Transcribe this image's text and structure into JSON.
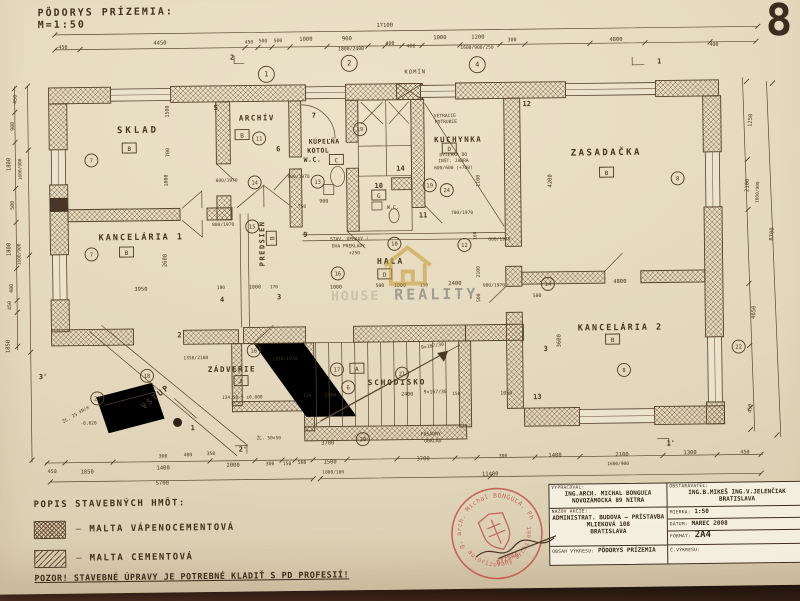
{
  "header": {
    "title": "PÔDORYS PRÍZEMIA:",
    "scale": "M=1:50",
    "sheet_number": "8"
  },
  "watermark": {
    "text_left": "HOUSE",
    "text_right": "REALITY",
    "house_color": "#c79a2e"
  },
  "legend": {
    "title": "POPIS STAVEBNÝCH HMÔT:",
    "items": [
      "MALTA VÁPENOCEMENTOVÁ",
      "MALTA CEMENTOVÁ"
    ],
    "dash": "—",
    "warning": "POZOR! STAVEBNÉ ÚPRAVY JE POTREBNÉ KLADIŤ S PD PROFESIÍ!"
  },
  "titleblock": {
    "vypracoval_label": "VYPRACOVAL:",
    "vypracoval1": "ING.ARCH. MICHAL BONGUĽA",
    "vypracoval2": "NOVOZÁMOCKÁ 89 NITRA",
    "obstaravatel_label": "OBSTARÁVATEĽ:",
    "obstaravatel1": "ING.B.MIKEŠ  ING.V.JELENČIAK",
    "obstaravatel2": "BRATISLAVA",
    "nazov_label": "NÁZOV AKCIE:",
    "nazov1": "ADMINISTRAT. BUDOVA – PRÍSTAVBA",
    "nazov2": "MLIEKOVÁ 108",
    "nazov3": "BRATISLAVA",
    "mierka_label": "MIERKA:",
    "mierka": "1:50",
    "datum_label": "DÁTUM:",
    "datum": "MAREC 2008",
    "format_label": "FORMÁT:",
    "format": "2A4",
    "cislo_label": "Č.VÝKRESU:",
    "cislo": "",
    "obsah_label": "OBSAH VÝKRESU:",
    "obsah": "PÔDORYS PRÍZEMIA"
  },
  "stamp": {
    "arc_top": "Ing. arch. Michal BONGUĽA, PhD.",
    "arc_bottom": "autorizovaný architekt",
    "code": "0725AA",
    "color": "#bf4f49"
  },
  "plan": {
    "rooms": [
      {
        "name": "SKLAD",
        "x": 137,
        "y": 134,
        "s": 9,
        "ls": 3
      },
      {
        "name": "KANCELÁRIA 1",
        "x": 139,
        "y": 241,
        "s": 8.5,
        "ls": 2
      },
      {
        "name": "ARCHÍV",
        "x": 256,
        "y": 123,
        "s": 7.5,
        "ls": 1.5
      },
      {
        "name": "PREDSIEŇ",
        "x": 262,
        "y": 246,
        "s": 7,
        "ls": 1.5,
        "r": -90
      },
      {
        "name": "KÚPEĽŇA",
        "x": 323,
        "y": 147,
        "s": 6.5,
        "ls": 0.5
      },
      {
        "name": "KOTOL",
        "x": 317,
        "y": 156,
        "s": 6.5,
        "ls": 0.5
      },
      {
        "name": "W.C.",
        "x": 311,
        "y": 165,
        "s": 6.5,
        "ls": 0.5
      },
      {
        "name": "KUCHYNKA",
        "x": 457,
        "y": 147,
        "s": 7.5,
        "ls": 1.5
      },
      {
        "name": "ZASADAČKA",
        "x": 605,
        "y": 162,
        "s": 9,
        "ls": 2.5
      },
      {
        "name": "HALA",
        "x": 388,
        "y": 268,
        "s": 8,
        "ls": 2
      },
      {
        "name": "KANCELÁRIA 2",
        "x": 617,
        "y": 337,
        "s": 8.5,
        "ls": 2
      },
      {
        "name": "ZÁDVERIE",
        "x": 228,
        "y": 374,
        "s": 7.5,
        "ls": 1.5
      },
      {
        "name": "VSTUP",
        "x": 153,
        "y": 400,
        "s": 8,
        "ls": 2,
        "r": -38
      },
      {
        "name": "SCHODISKO",
        "x": 393,
        "y": 389,
        "s": 7.5,
        "ls": 2
      }
    ],
    "letter_boxes": [
      {
        "t": "B",
        "x": 128,
        "y": 150
      },
      {
        "t": "B",
        "x": 124,
        "y": 254
      },
      {
        "t": "B",
        "x": 241,
        "y": 138
      },
      {
        "t": "C",
        "x": 335,
        "y": 164
      },
      {
        "t": "D",
        "x": 448,
        "y": 154
      },
      {
        "t": "B",
        "x": 605,
        "y": 180
      },
      {
        "t": "D",
        "x": 382,
        "y": 279
      },
      {
        "t": "B",
        "x": 609,
        "y": 347
      },
      {
        "t": "A",
        "x": 237,
        "y": 384
      },
      {
        "t": "A",
        "x": 353,
        "y": 373
      },
      {
        "t": "G",
        "x": 377,
        "y": 200
      },
      {
        "t": "B",
        "x": 270,
        "y": 241,
        "r": -90
      }
    ],
    "circle_marks": [
      {
        "n": "7",
        "x": 90,
        "y": 161
      },
      {
        "n": "7",
        "x": 89,
        "y": 255
      },
      {
        "n": "11",
        "x": 258,
        "y": 141
      },
      {
        "n": "14",
        "x": 253,
        "y": 185
      },
      {
        "n": "15",
        "x": 250,
        "y": 229
      },
      {
        "n": "13",
        "x": 316,
        "y": 185
      },
      {
        "n": "19",
        "x": 359,
        "y": 133
      },
      {
        "n": "19",
        "x": 428,
        "y": 190
      },
      {
        "n": "24",
        "x": 445,
        "y": 195
      },
      {
        "n": "12",
        "x": 462,
        "y": 250
      },
      {
        "n": "10",
        "x": 392,
        "y": 248
      },
      {
        "n": "16",
        "x": 335,
        "y": 277
      },
      {
        "n": "8",
        "x": 676,
        "y": 186
      },
      {
        "n": "8",
        "x": 620,
        "y": 377
      },
      {
        "n": "14",
        "x": 545,
        "y": 290
      },
      {
        "n": "16",
        "x": 250,
        "y": 353
      },
      {
        "n": "18",
        "x": 143,
        "y": 377
      },
      {
        "n": "23",
        "x": 93,
        "y": 399
      },
      {
        "n": "17",
        "x": 333,
        "y": 373
      },
      {
        "n": "21",
        "x": 398,
        "y": 378
      },
      {
        "n": "6",
        "x": 344,
        "y": 391
      },
      {
        "n": "20",
        "x": 358,
        "y": 443
      },
      {
        "n": "22",
        "x": 735,
        "y": 355
      }
    ],
    "grid_marks": [
      {
        "n": "1",
        "x": 266,
        "y": 77
      },
      {
        "n": "2",
        "x": 349,
        "y": 67
      },
      {
        "n": "4",
        "x": 477,
        "y": 70
      }
    ],
    "wall_marks": [
      {
        "t": "5",
        "x": 215,
        "y": 112
      },
      {
        "t": "6",
        "x": 277,
        "y": 154
      },
      {
        "t": "12",
        "x": 526,
        "y": 112
      },
      {
        "t": "11",
        "x": 421,
        "y": 222
      },
      {
        "t": "13",
        "x": 533,
        "y": 405
      },
      {
        "t": "4",
        "x": 219,
        "y": 304
      },
      {
        "t": "3",
        "x": 276,
        "y": 302
      },
      {
        "t": "9",
        "x": 303,
        "y": 240
      },
      {
        "t": "10",
        "x": 377,
        "y": 192
      },
      {
        "t": "14",
        "x": 399,
        "y": 175
      },
      {
        "t": "2",
        "x": 176,
        "y": 339
      },
      {
        "t": "1",
        "x": 188,
        "y": 432
      },
      {
        "t": "7",
        "x": 313,
        "y": 121
      },
      {
        "t": "2",
        "x": 232,
        "y": 62
      },
      {
        "t": "1",
        "x": 659,
        "y": 71
      },
      {
        "t": "1'",
        "x": 666,
        "y": 453
      },
      {
        "t": "2'",
        "x": 238,
        "y": 454
      },
      {
        "t": "3'",
        "x": 39,
        "y": 379
      },
      {
        "t": "3",
        "x": 542,
        "y": 357
      }
    ],
    "dim_texts": [
      {
        "t": "17100",
        "x": 385,
        "y": 31
      },
      {
        "t": "450",
        "x": 63,
        "y": 49,
        "s": 5
      },
      {
        "t": "4450",
        "x": 160,
        "y": 46
      },
      {
        "t": "450",
        "x": 249,
        "y": 46,
        "s": 4.8
      },
      {
        "t": "500",
        "x": 263,
        "y": 45,
        "s": 4.8
      },
      {
        "t": "500",
        "x": 278,
        "y": 45,
        "s": 4.8
      },
      {
        "t": "1000",
        "x": 306,
        "y": 44
      },
      {
        "t": "900",
        "x": 347,
        "y": 44
      },
      {
        "t": "1800/2400",
        "x": 351,
        "y": 54,
        "s": 4.8
      },
      {
        "t": "400",
        "x": 390,
        "y": 49,
        "s": 5
      },
      {
        "t": "400",
        "x": 411,
        "y": 52,
        "s": 5
      },
      {
        "t": "1000",
        "x": 440,
        "y": 44
      },
      {
        "t": "1200",
        "x": 478,
        "y": 44
      },
      {
        "t": "1600/900/250",
        "x": 477,
        "y": 54,
        "s": 4.6
      },
      {
        "t": "300",
        "x": 512,
        "y": 47,
        "s": 5
      },
      {
        "t": "4800",
        "x": 616,
        "y": 48
      },
      {
        "t": "400",
        "x": 714,
        "y": 54,
        "s": 5
      },
      {
        "t": "450",
        "x": 16,
        "y": 99,
        "r": -90,
        "s": 5
      },
      {
        "t": "900",
        "x": 13,
        "y": 126,
        "r": -90,
        "s": 5
      },
      {
        "t": "1800",
        "x": 9,
        "y": 164,
        "r": -90,
        "s": 5.5
      },
      {
        "t": "1600/900",
        "x": 20,
        "y": 169,
        "r": -90,
        "s": 4.5
      },
      {
        "t": "500",
        "x": 12,
        "y": 205,
        "r": -90,
        "s": 5
      },
      {
        "t": "1800",
        "x": 8,
        "y": 249,
        "r": -90,
        "s": 5.5
      },
      {
        "t": "1600/900",
        "x": 18,
        "y": 254,
        "r": -90,
        "s": 4.5
      },
      {
        "t": "400",
        "x": 10,
        "y": 288,
        "r": -90,
        "s": 5
      },
      {
        "t": "450",
        "x": 8,
        "y": 305,
        "r": -90,
        "s": 5
      },
      {
        "t": "1850",
        "x": 6,
        "y": 346,
        "r": -90,
        "s": 5.5
      },
      {
        "t": "1250",
        "x": 751,
        "y": 129,
        "r": -87,
        "s": 5.5
      },
      {
        "t": "2100",
        "x": 747,
        "y": 194,
        "r": -87,
        "s": 5.5
      },
      {
        "t": "1600/900",
        "x": 757,
        "y": 201,
        "r": -87,
        "s": 4.5
      },
      {
        "t": "4650",
        "x": 752,
        "y": 321,
        "r": -87,
        "s": 5.5
      },
      {
        "t": "8700",
        "x": 771,
        "y": 243,
        "r": -87,
        "s": 5.5
      },
      {
        "t": "450",
        "x": 747,
        "y": 417,
        "r": -87,
        "s": 5
      },
      {
        "t": "450",
        "x": 47,
        "y": 473,
        "s": 5
      },
      {
        "t": "1850",
        "x": 82,
        "y": 474,
        "s": 5.5
      },
      {
        "t": "1400",
        "x": 158,
        "y": 471
      },
      {
        "t": "2000",
        "x": 228,
        "y": 469
      },
      {
        "t": "300",
        "x": 265,
        "y": 468,
        "s": 4.8
      },
      {
        "t": "150",
        "x": 282,
        "y": 468,
        "s": 4.8
      },
      {
        "t": "500",
        "x": 297,
        "y": 467,
        "s": 4.8
      },
      {
        "t": "1500",
        "x": 325,
        "y": 467,
        "s": 5.5
      },
      {
        "t": "1800/100",
        "x": 328,
        "y": 477,
        "s": 4.5
      },
      {
        "t": "5700",
        "x": 157,
        "y": 486
      },
      {
        "t": "300",
        "x": 158,
        "y": 459,
        "s": 4.8
      },
      {
        "t": "400",
        "x": 183,
        "y": 458,
        "s": 4.8
      },
      {
        "t": "350",
        "x": 206,
        "y": 457,
        "s": 4.8
      },
      {
        "t": "3700",
        "x": 323,
        "y": 448
      },
      {
        "t": "3700",
        "x": 418,
        "y": 465
      },
      {
        "t": "300",
        "x": 498,
        "y": 463,
        "s": 4.8
      },
      {
        "t": "1400",
        "x": 550,
        "y": 463
      },
      {
        "t": "2100",
        "x": 617,
        "y": 463
      },
      {
        "t": "1600/900",
        "x": 613,
        "y": 472,
        "s": 4.5
      },
      {
        "t": "1300",
        "x": 685,
        "y": 462
      },
      {
        "t": "450",
        "x": 740,
        "y": 462,
        "s": 5
      },
      {
        "t": "11400",
        "x": 485,
        "y": 481
      },
      {
        "t": "1500",
        "x": 168,
        "y": 113,
        "r": -90,
        "s": 5
      },
      {
        "t": "700",
        "x": 168,
        "y": 154,
        "r": -90,
        "s": 5
      },
      {
        "t": "1000",
        "x": 166,
        "y": 182,
        "r": -90,
        "s": 5
      },
      {
        "t": "2600",
        "x": 164,
        "y": 262,
        "r": -90,
        "s": 5.5
      },
      {
        "t": "1100",
        "x": 478,
        "y": 186,
        "r": -90,
        "s": 5
      },
      {
        "t": "4200",
        "x": 550,
        "y": 187,
        "r": -90,
        "s": 5.5
      },
      {
        "t": "2100",
        "x": 477,
        "y": 277,
        "r": -90,
        "s": 4.8
      },
      {
        "t": "500",
        "x": 477,
        "y": 303,
        "r": -90,
        "s": 4.8
      },
      {
        "t": "160",
        "x": 474,
        "y": 241,
        "r": -90,
        "s": 4.5
      },
      {
        "t": "3600",
        "x": 557,
        "y": 347,
        "r": -90,
        "s": 5.5
      },
      {
        "t": "3950",
        "x": 138,
        "y": 292,
        "s": 5.5
      },
      {
        "t": "100",
        "x": 218,
        "y": 291,
        "s": 4.5
      },
      {
        "t": "1000",
        "x": 252,
        "y": 291,
        "s": 5
      },
      {
        "t": "170",
        "x": 271,
        "y": 291,
        "s": 4.5
      },
      {
        "t": "600/1970",
        "x": 225,
        "y": 184,
        "s": 4.6
      },
      {
        "t": "800/1970",
        "x": 221,
        "y": 228,
        "s": 4.6
      },
      {
        "t": "800/1970",
        "x": 297,
        "y": 181,
        "s": 4.6
      },
      {
        "t": "900",
        "x": 322,
        "y": 206,
        "s": 5
      },
      {
        "t": "750",
        "x": 300,
        "y": 211,
        "s": 4.6
      },
      {
        "t": "700/1970",
        "x": 460,
        "y": 219,
        "s": 4.6
      },
      {
        "t": "800/1970",
        "x": 497,
        "y": 246,
        "s": 4.6
      },
      {
        "t": "900/1970",
        "x": 491,
        "y": 292,
        "s": 4.6
      },
      {
        "t": "1000",
        "x": 333,
        "y": 292,
        "s": 5
      },
      {
        "t": "500",
        "x": 377,
        "y": 291,
        "s": 4.8
      },
      {
        "t": "1000",
        "x": 397,
        "y": 291,
        "s": 5
      },
      {
        "t": "150",
        "x": 421,
        "y": 291,
        "s": 4.5
      },
      {
        "t": "2400",
        "x": 452,
        "y": 290,
        "s": 5.5
      },
      {
        "t": "4800",
        "x": 617,
        "y": 290,
        "s": 5.5
      },
      {
        "t": "500",
        "x": 534,
        "y": 303,
        "s": 4.8
      },
      {
        "t": "2400",
        "x": 403,
        "y": 400,
        "s": 5
      },
      {
        "t": "150",
        "x": 452,
        "y": 400,
        "s": 4.5
      },
      {
        "t": "150",
        "x": 303,
        "y": 400,
        "s": 4.5
      },
      {
        "t": "1800",
        "x": 326,
        "y": 400,
        "s": 5
      },
      {
        "t": "1050",
        "x": 502,
        "y": 400,
        "s": 5
      },
      {
        "t": "1350/2100",
        "x": 192,
        "y": 361,
        "s": 4.6
      },
      {
        "t": "1350/1970",
        "x": 281,
        "y": 363,
        "s": 4.6
      }
    ],
    "notes": [
      {
        "t": "KOMÍN",
        "x": 415,
        "y": 78,
        "s": 5.5,
        "ls": 1
      },
      {
        "t": "VETRACIE",
        "x": 444,
        "y": 122,
        "s": 4.6
      },
      {
        "t": "POTRUBIE",
        "x": 445,
        "y": 128,
        "s": 4.6
      },
      {
        "t": "DVIERKA DO",
        "x": 452,
        "y": 161,
        "s": 4.6
      },
      {
        "t": "INŠT. JADRA",
        "x": 452,
        "y": 167,
        "s": 4.6
      },
      {
        "t": "600/600 (+700)",
        "x": 452,
        "y": 174,
        "s": 4.6
      },
      {
        "t": "STAV. ÚPRAVY !",
        "x": 347,
        "y": 244,
        "s": 4.6
      },
      {
        "t": "DVA PREKLADY",
        "x": 346,
        "y": 251,
        "s": 4.6
      },
      {
        "t": "+250",
        "x": 352,
        "y": 258,
        "s": 4.6
      },
      {
        "t": "W.C.",
        "x": 391,
        "y": 213,
        "s": 5
      },
      {
        "t": "FASÁDNY",
        "x": 426,
        "y": 440,
        "s": 4.8
      },
      {
        "t": "OBKLAD",
        "x": 428,
        "y": 447,
        "s": 4.8
      },
      {
        "t": "9×167/30",
        "x": 429,
        "y": 352,
        "s": 4.8,
        "r": -8
      },
      {
        "t": "9×167/30",
        "x": 431,
        "y": 398,
        "s": 4.8
      },
      {
        "t": "ŽĽ. 25 kN/m",
        "x": 72,
        "y": 416,
        "s": 4.5,
        "r": -30
      },
      {
        "t": "-0,020",
        "x": 84,
        "y": 425,
        "s": 4.5
      },
      {
        "t": "134,58 = ±0,000",
        "x": 238,
        "y": 401,
        "s": 4.5
      },
      {
        "t": "ŽĽ. 50×50",
        "x": 264,
        "y": 442,
        "s": 4.5
      }
    ]
  }
}
